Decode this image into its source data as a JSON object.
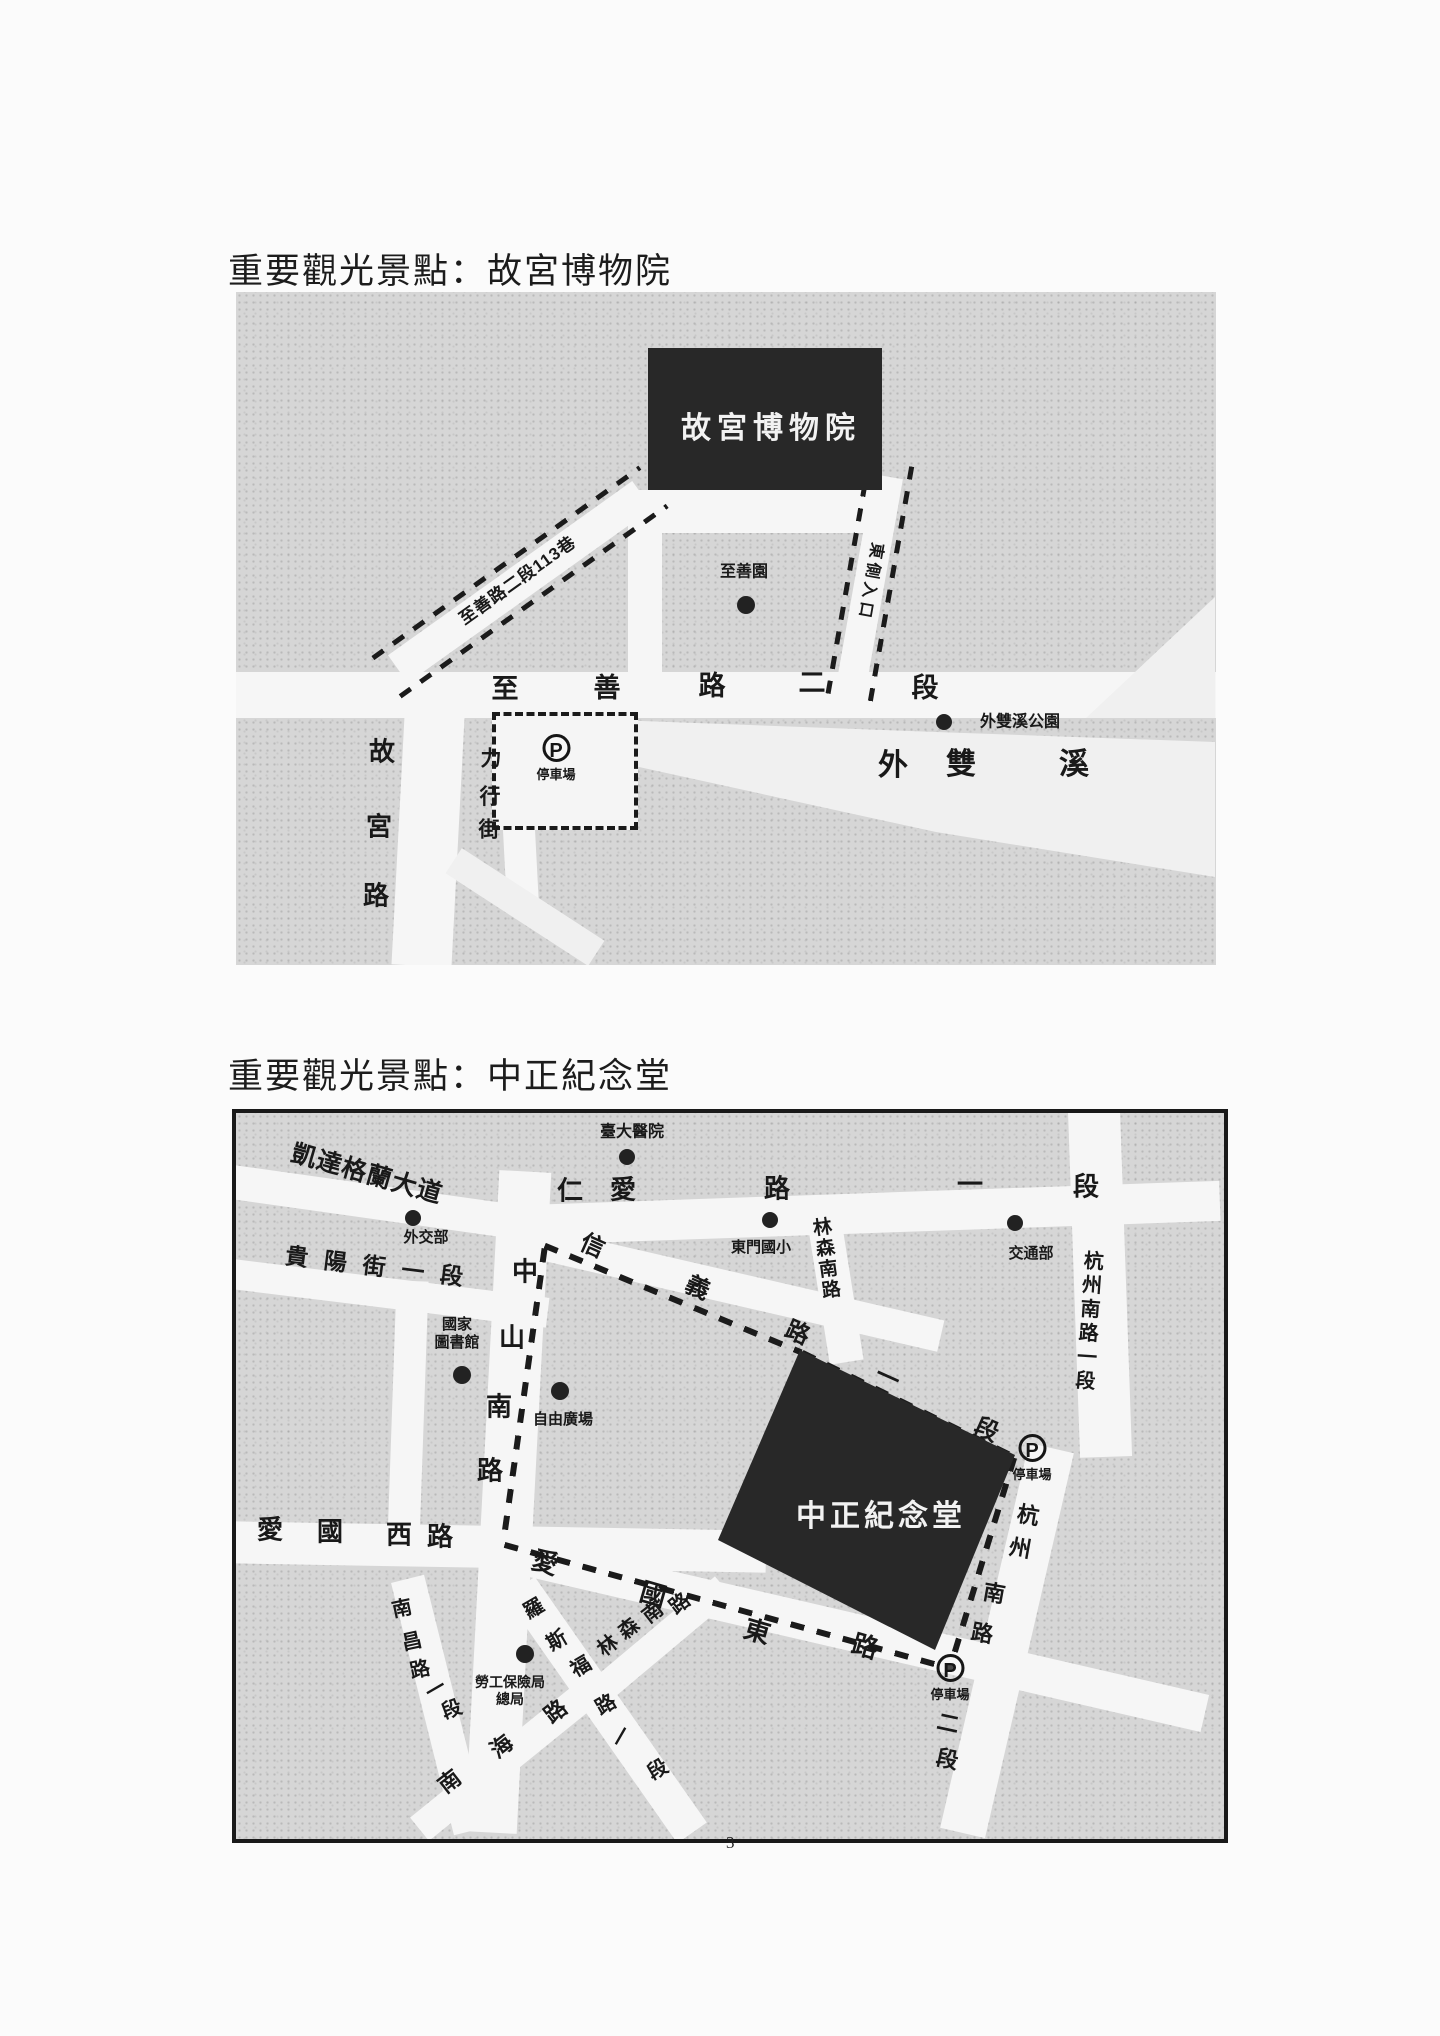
{
  "page": {
    "number": "3"
  },
  "sections": [
    {
      "heading": "重要觀光景點：故宮博物院"
    },
    {
      "heading": "重要觀光景點：中正紀念堂"
    }
  ],
  "map1": {
    "labels": [
      {
        "n": "label-palace-museum",
        "t": "故宮博物院",
        "x": 535,
        "y": 137,
        "s": 30,
        "ls": 6,
        "w": true
      },
      {
        "n": "label-zhishan-lane-113",
        "t": "至善路二段113巷",
        "x": 282,
        "y": 289,
        "s": 17,
        "r": -35.5,
        "ls": 1
      },
      {
        "n": "label-east-entrance",
        "t": "東側入口",
        "x": 634,
        "y": 290,
        "s": 16,
        "r": 100,
        "ls": 4
      },
      {
        "n": "label-zhishan-garden",
        "t": "至善園",
        "x": 508,
        "y": 280,
        "s": 16
      },
      {
        "n": "road-char-zhishan-rd",
        "t": "至",
        "x": 269,
        "y": 397,
        "s": 27
      },
      {
        "n": "road-char-zhishan-rd",
        "t": "善",
        "x": 371,
        "y": 396,
        "s": 27
      },
      {
        "n": "road-char-zhishan-rd",
        "t": "路",
        "x": 476,
        "y": 394,
        "s": 27
      },
      {
        "n": "road-char-zhishan-rd",
        "t": "二",
        "x": 576,
        "y": 391,
        "s": 27
      },
      {
        "n": "road-char-zhishan-rd",
        "t": "段",
        "x": 689,
        "y": 396,
        "s": 27
      },
      {
        "n": "label-waishuangxi-park",
        "t": "外雙溪公園",
        "x": 784,
        "y": 430,
        "s": 16
      },
      {
        "n": "river-char-waishuangxi",
        "t": "外",
        "x": 657,
        "y": 474,
        "s": 30
      },
      {
        "n": "river-char-waishuangxi",
        "t": "雙",
        "x": 725,
        "y": 473,
        "s": 30
      },
      {
        "n": "river-char-waishuangxi",
        "t": "溪",
        "x": 838,
        "y": 473,
        "s": 30
      },
      {
        "n": "road-char-gugong-rd",
        "t": "故",
        "x": 146,
        "y": 460,
        "s": 26
      },
      {
        "n": "road-char-gugong-rd",
        "t": "宮",
        "x": 143,
        "y": 535,
        "s": 26
      },
      {
        "n": "road-char-gugong-rd",
        "t": "路",
        "x": 140,
        "y": 604,
        "s": 26
      },
      {
        "n": "road-char-lixing-st",
        "t": "力",
        "x": 255,
        "y": 467,
        "s": 21
      },
      {
        "n": "road-char-lixing-st",
        "t": "行",
        "x": 254,
        "y": 505,
        "s": 21
      },
      {
        "n": "road-char-lixing-st",
        "t": "街",
        "x": 253,
        "y": 538,
        "s": 21
      }
    ],
    "dots": [
      {
        "n": "dot-zhishan-garden",
        "x": 510,
        "y": 313,
        "r": 9
      },
      {
        "n": "dot-waishuangxi-park",
        "x": 708,
        "y": 430,
        "r": 8
      }
    ],
    "parkings": [
      {
        "n": "parking-zhishan",
        "x": 320,
        "y": 458,
        "sym": "P",
        "label": "停車場"
      }
    ]
  },
  "map2": {
    "labels": [
      {
        "n": "label-cks-memorial",
        "t": "中正紀念堂",
        "x": 645,
        "y": 404,
        "s": 30,
        "ls": 4,
        "w": true
      },
      {
        "n": "label-ntu-hospital",
        "t": "臺大醫院",
        "x": 396,
        "y": 19,
        "s": 16
      },
      {
        "n": "label-ketagalan-blvd",
        "t": "凱達格蘭大道",
        "x": 131,
        "y": 61,
        "s": 25,
        "r": 16,
        "ls": 1
      },
      {
        "n": "road-char-renai-rd",
        "t": "仁",
        "x": 334,
        "y": 78,
        "s": 26
      },
      {
        "n": "road-char-renai-rd",
        "t": "愛",
        "x": 387,
        "y": 77,
        "s": 26
      },
      {
        "n": "road-char-renai-rd",
        "t": "路",
        "x": 541,
        "y": 76,
        "s": 26
      },
      {
        "n": "road-char-renai-rd",
        "t": "一",
        "x": 734,
        "y": 72,
        "s": 26
      },
      {
        "n": "road-char-renai-rd",
        "t": "段",
        "x": 850,
        "y": 74,
        "s": 26
      },
      {
        "n": "label-mofa",
        "t": "外交部",
        "x": 190,
        "y": 125,
        "s": 15
      },
      {
        "n": "label-dongmen-school",
        "t": "東門國小",
        "x": 525,
        "y": 135,
        "s": 15
      },
      {
        "n": "label-motc",
        "t": "交通部",
        "x": 795,
        "y": 141,
        "s": 15
      },
      {
        "n": "label-hangzhou-s-rd-1",
        "t": "杭州南路一段",
        "x": 851,
        "y": 209,
        "s": 20,
        "r": 4,
        "v": true,
        "ls": 4
      },
      {
        "n": "label-guiyang-st",
        "t": "貴陽街一段",
        "x": 146,
        "y": 155,
        "s": 23,
        "r": 7,
        "ls": 16
      },
      {
        "n": "road-char-zhongshan-s",
        "t": "中",
        "x": 289,
        "y": 159,
        "s": 26
      },
      {
        "n": "road-char-zhongshan-s",
        "t": "山",
        "x": 276,
        "y": 225,
        "s": 26
      },
      {
        "n": "road-char-zhongshan-s",
        "t": "南",
        "x": 263,
        "y": 294,
        "s": 26
      },
      {
        "n": "road-char-zhongshan-s",
        "t": "路",
        "x": 254,
        "y": 358,
        "s": 26
      },
      {
        "n": "route-char-xinyi-rd",
        "t": "信",
        "x": 356,
        "y": 134,
        "s": 24,
        "r": 24
      },
      {
        "n": "route-char-xinyi-rd",
        "t": "義",
        "x": 461,
        "y": 176,
        "s": 24,
        "r": 24
      },
      {
        "n": "route-char-xinyi-rd",
        "t": "路",
        "x": 561,
        "y": 221,
        "s": 24,
        "r": 24
      },
      {
        "n": "route-char-xinyi-rd",
        "t": "一",
        "x": 651,
        "y": 266,
        "s": 24,
        "r": 24
      },
      {
        "n": "route-char-xinyi-rd",
        "t": "段",
        "x": 750,
        "y": 318,
        "s": 24,
        "r": 24
      },
      {
        "n": "label-linsen-s-rd-north",
        "t": "林森南路",
        "x": 588,
        "y": 146,
        "s": 19,
        "r": -8,
        "v": true,
        "ls": 2
      },
      {
        "n": "label-national-library",
        "t": [
          "國家",
          "圖書館"
        ],
        "x": 221,
        "y": 221,
        "s": 15
      },
      {
        "n": "label-liberty-square",
        "t": "自由廣場",
        "x": 327,
        "y": 307,
        "s": 15
      },
      {
        "n": "road-char-hangzhou-mid",
        "t": "杭",
        "x": 792,
        "y": 403,
        "s": 22,
        "r": 10
      },
      {
        "n": "road-char-hangzhou-mid",
        "t": "州",
        "x": 784,
        "y": 436,
        "s": 22,
        "r": 10
      },
      {
        "n": "road-char-hangzhou-mid",
        "t": "南",
        "x": 758,
        "y": 481,
        "s": 22,
        "r": 10
      },
      {
        "n": "road-char-hangzhou-mid",
        "t": "路",
        "x": 746,
        "y": 521,
        "s": 22,
        "r": 10
      },
      {
        "n": "road-char-hangzhou-2",
        "t": "二",
        "x": 712,
        "y": 611,
        "s": 22,
        "r": 12
      },
      {
        "n": "road-char-hangzhou-2",
        "t": "段",
        "x": 711,
        "y": 647,
        "s": 22,
        "r": 12
      },
      {
        "n": "road-char-aiguo-w",
        "t": "愛",
        "x": 34,
        "y": 417,
        "s": 26
      },
      {
        "n": "road-char-aiguo-w",
        "t": "國",
        "x": 94,
        "y": 419,
        "s": 26
      },
      {
        "n": "road-char-aiguo-w",
        "t": "西",
        "x": 163,
        "y": 422,
        "s": 26
      },
      {
        "n": "road-char-aiguo-w",
        "t": "路",
        "x": 204,
        "y": 424,
        "s": 26
      },
      {
        "n": "road-char-aiguo-e",
        "t": "愛",
        "x": 309,
        "y": 450,
        "s": 26,
        "r": 16
      },
      {
        "n": "road-char-aiguo-e",
        "t": "國",
        "x": 417,
        "y": 482,
        "s": 26,
        "r": 16
      },
      {
        "n": "road-char-aiguo-e",
        "t": "東",
        "x": 521,
        "y": 519,
        "s": 26,
        "r": 16
      },
      {
        "n": "road-char-aiguo-e",
        "t": "路",
        "x": 629,
        "y": 534,
        "s": 26,
        "r": 16
      },
      {
        "n": "road-char-nanchang",
        "t": "南",
        "x": 166,
        "y": 496,
        "s": 20,
        "r": -12
      },
      {
        "n": "road-char-nanchang",
        "t": "昌",
        "x": 176,
        "y": 529,
        "s": 20,
        "r": -12
      },
      {
        "n": "road-char-nanchang",
        "t": "路",
        "x": 184,
        "y": 557,
        "s": 20,
        "r": -12
      },
      {
        "n": "road-char-nanchang",
        "t": "一",
        "x": 200,
        "y": 577,
        "s": 20,
        "r": -30
      },
      {
        "n": "road-char-nanchang",
        "t": "段",
        "x": 216,
        "y": 597,
        "s": 20,
        "r": -20
      },
      {
        "n": "road-char-roosevelt",
        "t": "羅",
        "x": 298,
        "y": 496,
        "s": 20,
        "r": -30
      },
      {
        "n": "road-char-roosevelt",
        "t": "斯",
        "x": 321,
        "y": 528,
        "s": 20,
        "r": -30
      },
      {
        "n": "road-char-roosevelt",
        "t": "福",
        "x": 345,
        "y": 554,
        "s": 20,
        "r": -30
      },
      {
        "n": "road-char-roosevelt",
        "t": "路",
        "x": 370,
        "y": 592,
        "s": 20,
        "r": -30
      },
      {
        "n": "road-char-roosevelt",
        "t": "一",
        "x": 386,
        "y": 624,
        "s": 20,
        "r": -60
      },
      {
        "n": "road-char-roosevelt",
        "t": "段",
        "x": 422,
        "y": 657,
        "s": 20,
        "r": -30
      },
      {
        "n": "road-char-linsen-south",
        "t": "林",
        "x": 372,
        "y": 533,
        "s": 20,
        "r": -38
      },
      {
        "n": "road-char-linsen-south",
        "t": "森",
        "x": 393,
        "y": 516,
        "s": 20,
        "r": -38
      },
      {
        "n": "road-char-linsen-south",
        "t": "南",
        "x": 417,
        "y": 500,
        "s": 20,
        "r": -38
      },
      {
        "n": "road-char-linsen-south",
        "t": "路",
        "x": 444,
        "y": 491,
        "s": 20,
        "r": -38
      },
      {
        "n": "road-char-nanhai",
        "t": "南",
        "x": 214,
        "y": 669,
        "s": 22,
        "r": -38
      },
      {
        "n": "road-char-nanhai",
        "t": "海",
        "x": 266,
        "y": 634,
        "s": 22,
        "r": -38
      },
      {
        "n": "road-char-nanhai",
        "t": "路",
        "x": 320,
        "y": 599,
        "s": 22,
        "r": -38
      },
      {
        "n": "label-labor-insurance-bureau",
        "t": [
          "勞工保險局",
          "總局"
        ],
        "x": 274,
        "y": 578,
        "s": 14
      }
    ],
    "dots": [
      {
        "n": "dot-ntu-hospital",
        "x": 391,
        "y": 44,
        "r": 8
      },
      {
        "n": "dot-mofa",
        "x": 177,
        "y": 105,
        "r": 8
      },
      {
        "n": "dot-dongmen-school",
        "x": 534,
        "y": 107,
        "r": 8
      },
      {
        "n": "dot-motc",
        "x": 779,
        "y": 110,
        "r": 8
      },
      {
        "n": "dot-national-library",
        "x": 226,
        "y": 262,
        "r": 9
      },
      {
        "n": "dot-liberty-square",
        "x": 324,
        "y": 278,
        "r": 9
      },
      {
        "n": "dot-labor-insurance",
        "x": 289,
        "y": 541,
        "r": 9
      }
    ],
    "parkings": [
      {
        "n": "parking-hangzhou",
        "x": 796,
        "y": 337,
        "sym": "P",
        "label": "停車場"
      },
      {
        "n": "parking-aiguo-east",
        "x": 714,
        "y": 557,
        "sym": "P",
        "label": "停車場"
      }
    ]
  }
}
